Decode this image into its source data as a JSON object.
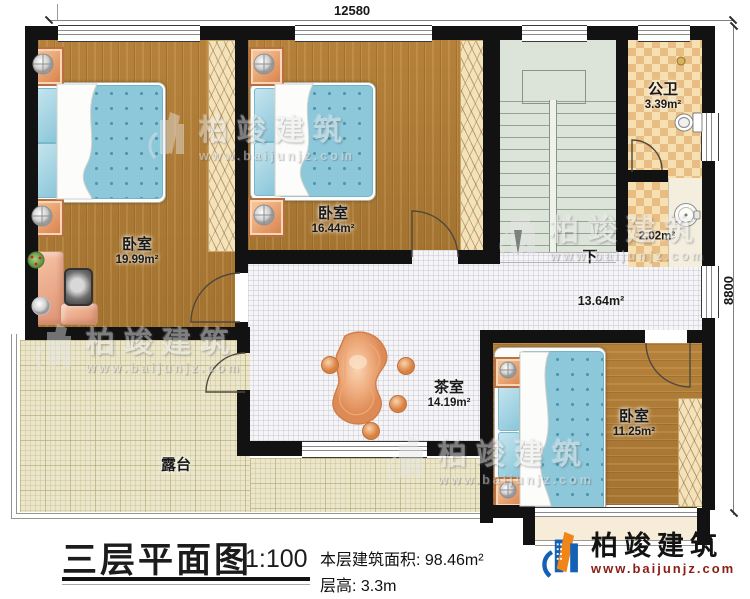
{
  "dimensions": {
    "width_top": "12580",
    "height_right": "8800"
  },
  "rooms": {
    "bedroom1": {
      "name": "卧室",
      "area": "19.99m²"
    },
    "bedroom2": {
      "name": "卧室",
      "area": "16.44m²"
    },
    "bedroom3": {
      "name": "卧室",
      "area": "11.25m²"
    },
    "tea_room": {
      "name": "茶室",
      "area": "14.19m²"
    },
    "public_bath": {
      "name": "公卫",
      "area": "3.39m²"
    },
    "wash_area": {
      "area": "2.02m²"
    },
    "hall": {
      "area": "13.64m²"
    },
    "terrace": {
      "name": "露台"
    },
    "stairs": {
      "direction_label": "下"
    }
  },
  "title_block": {
    "title": "三层平面图",
    "scale": "1:100",
    "area_line": "本层建筑面积: 98.46m²",
    "height_line": "层高: 3.3m"
  },
  "brand": {
    "name": "柏竣建筑",
    "website": "www.baijunjz.com"
  },
  "watermark": {
    "name": "柏竣建筑",
    "website": "www.baijunjz.com"
  },
  "colors": {
    "wall": "#121212",
    "wood": "#ad7c35",
    "bed_blue": "#8cc7da",
    "terrace": "#ebe6cb",
    "checker_dark": "#e7bd83",
    "checker_light": "#f6e0b2",
    "stair": "#dce3d8",
    "brand_blue": "#1261b5",
    "brand_orange": "#f08519",
    "brand_url_red": "#8b1d15"
  }
}
